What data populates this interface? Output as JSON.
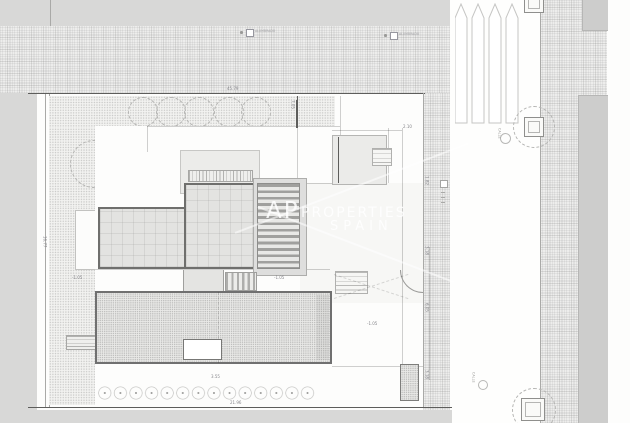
{
  "title": "roof-site-plan",
  "watermark": {
    "mono": "AP",
    "word": "PROPERTIES",
    "sub": "SPAIN"
  },
  "labels": {
    "dim_top": "45.79",
    "dim_bottom": "21.96",
    "dim_left": "16.77",
    "dim_garden": "7.05",
    "dim_gate": "2.10",
    "dim_plants": "3.55",
    "dim_r1": "1.82",
    "dim_r2": "3.18",
    "dim_r3": "6.05",
    "dim_r4": "3.18",
    "lvl_left": "-1.05",
    "lvl_mid": "-1.05",
    "lvl_court": "-1.05",
    "marker1": "ALUMBRADO",
    "marker2": "ALUMBRADO",
    "street1": "CALLE",
    "street2": "CALLE"
  },
  "colors": {
    "pavement": "#ededec",
    "garden": "#f2f2f0",
    "roof_border": "#6f6f6d",
    "gray_band": "#d8d8d7",
    "dim_text": "#85858a"
  }
}
